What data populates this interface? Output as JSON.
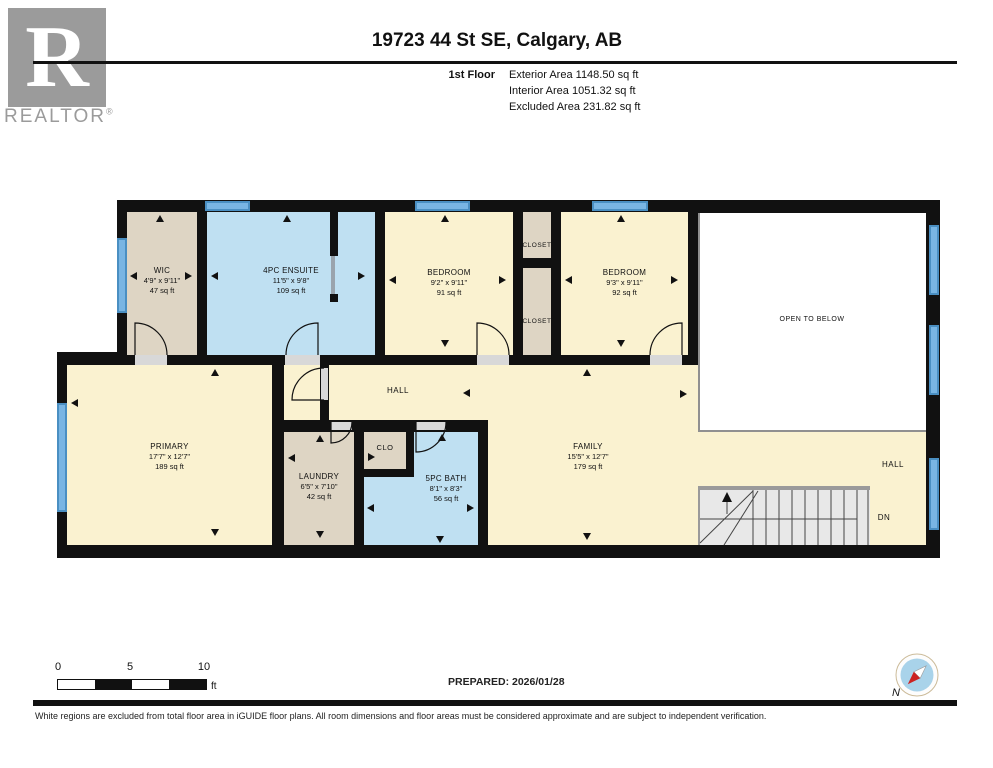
{
  "header": {
    "title": "19723 44 St SE, Calgary, AB",
    "floor_label": "1st Floor",
    "stats": [
      "Exterior Area 1148.50 sq ft",
      "Interior Area 1051.32 sq ft",
      "Excluded Area 231.82 sq ft"
    ]
  },
  "logo": {
    "letter": "R",
    "brand": "REALTOR",
    "registered": "®"
  },
  "rooms": {
    "wic": {
      "name": "WIC",
      "dims": "4'9\" x 9'11\"",
      "area": "47 sq ft"
    },
    "ensuite": {
      "name": "4PC ENSUITE",
      "dims": "11'5\" x 9'8\"",
      "area": "109 sq ft"
    },
    "bedroom1": {
      "name": "BEDROOM",
      "dims": "9'2\" x 9'11\"",
      "area": "91 sq ft"
    },
    "bedroom2": {
      "name": "BEDROOM",
      "dims": "9'3\" x 9'11\"",
      "area": "92 sq ft"
    },
    "primary": {
      "name": "PRIMARY",
      "dims": "17'7\" x 12'7\"",
      "area": "189 sq ft"
    },
    "laundry": {
      "name": "LAUNDRY",
      "dims": "6'5\" x 7'10\"",
      "area": "42 sq ft"
    },
    "bath": {
      "name": "5PC BATH",
      "dims": "8'1\" x 8'3\"",
      "area": "56 sq ft"
    },
    "family": {
      "name": "FAMILY",
      "dims": "15'5\" x 12'7\"",
      "area": "179 sq ft"
    }
  },
  "labels": {
    "closet_top": "CLOSET",
    "closet_bottom": "CLOSET",
    "clo": "CLO",
    "hall_upper": "HALL",
    "hall_lower": "HALL",
    "open_to_below": "OPEN TO BELOW",
    "dn": "DN",
    "north": "N"
  },
  "scalebar": {
    "t0": "0",
    "t5": "5",
    "t10": "10",
    "unit": "ft"
  },
  "footer": {
    "prepared": "PREPARED: 2026/01/28",
    "disclaimer": "White regions are excluded from total floor area in iGUIDE floor plans. All room dimensions and floor areas must be considered approximate and are subject to independent verification."
  },
  "colors": {
    "cream": "#FAF2D0",
    "tan": "#DED5C4",
    "blue": "#BFE0F2",
    "window": "#79B5E3",
    "wall": "#111111"
  }
}
